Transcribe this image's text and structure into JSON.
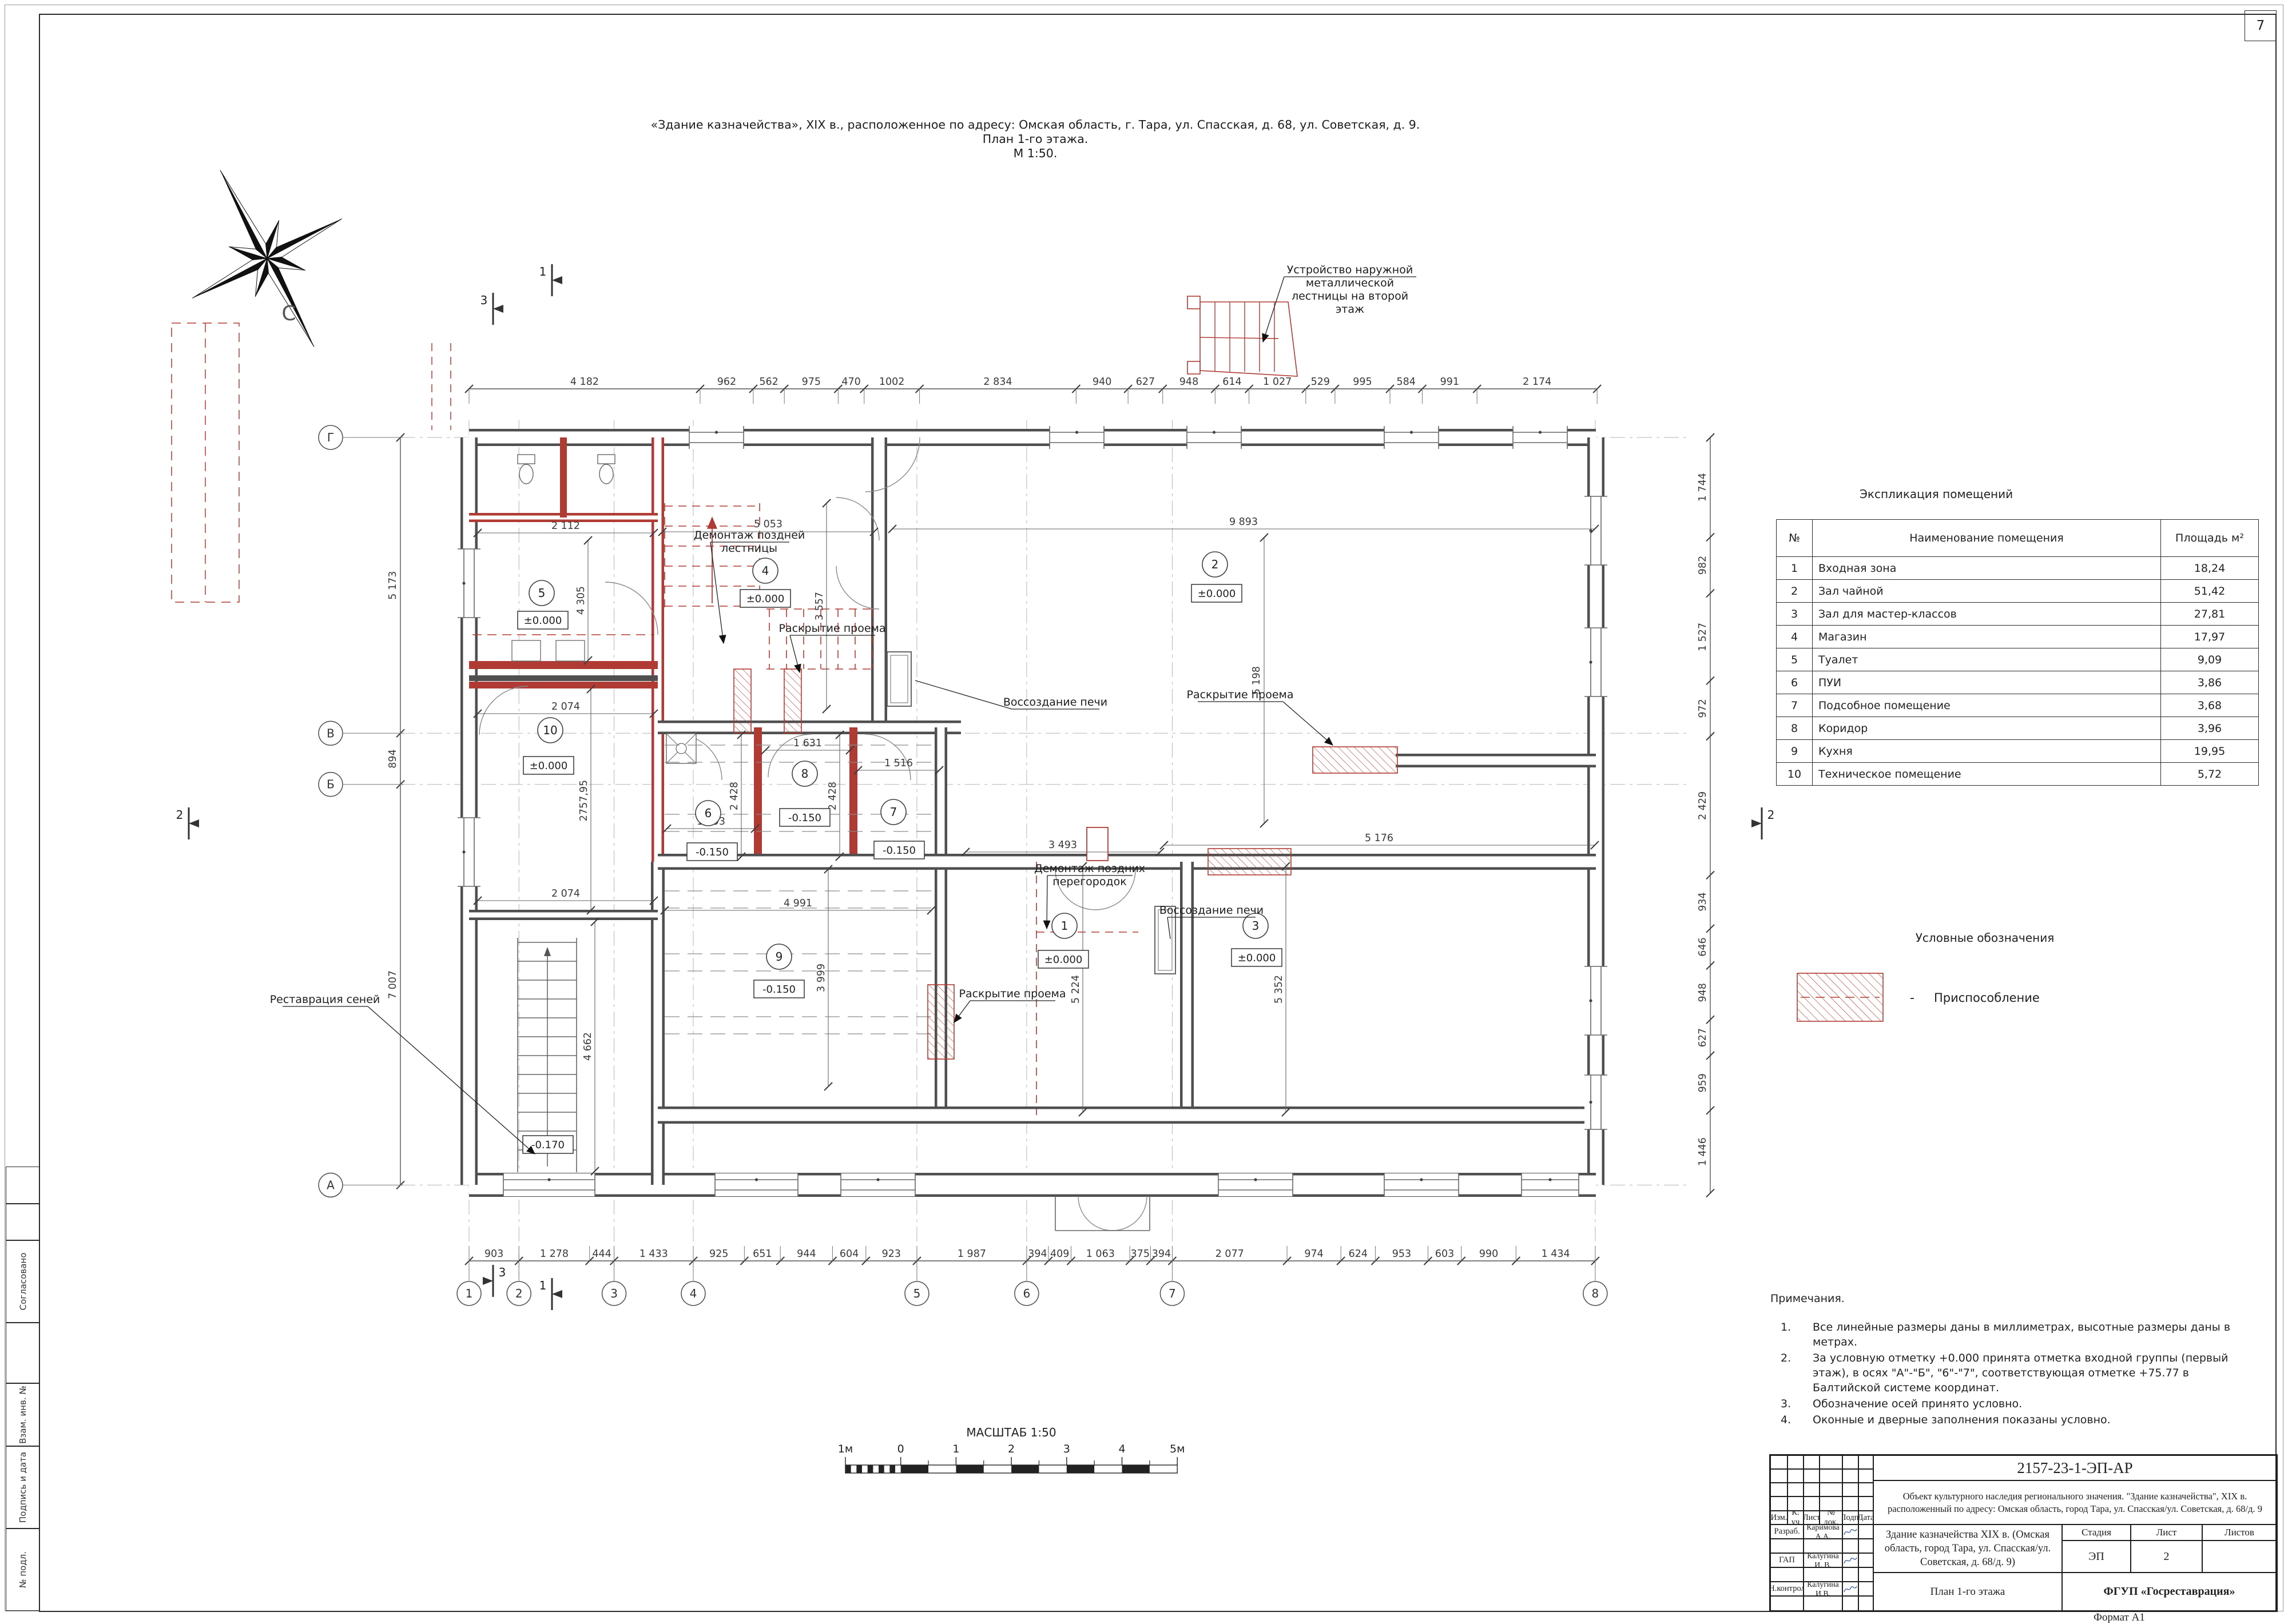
{
  "page": {
    "sheet_corner_number": "7",
    "format_label": "Формат А1"
  },
  "drawing_title": {
    "line1": "«Здание казначейства», XIX в., расположенное по адресу: Омская область, г. Тара, ул. Спасская, д. 68, ул. Советская, д. 9.",
    "line2": "План 1-го этажа.",
    "line3": "М 1:50."
  },
  "compass": {
    "north_label": "С"
  },
  "explication": {
    "title": "Экспликация помещений",
    "columns": [
      "№",
      "Наименование помещения",
      "Площадь м²"
    ],
    "rows": [
      {
        "num": "1",
        "name": "Входная зона",
        "area": "18,24"
      },
      {
        "num": "2",
        "name": "Зал чайной",
        "area": "51,42"
      },
      {
        "num": "3",
        "name": "Зал для мастер-классов",
        "area": "27,81"
      },
      {
        "num": "4",
        "name": "Магазин",
        "area": "17,97"
      },
      {
        "num": "5",
        "name": "Туалет",
        "area": "9,09"
      },
      {
        "num": "6",
        "name": "ПУИ",
        "area": "3,86"
      },
      {
        "num": "7",
        "name": "Подсобное помещение",
        "area": "3,68"
      },
      {
        "num": "8",
        "name": "Коридор",
        "area": "3,96"
      },
      {
        "num": "9",
        "name": "Кухня",
        "area": "19,95"
      },
      {
        "num": "10",
        "name": "Техническое помещение",
        "area": "5,72"
      }
    ]
  },
  "legend": {
    "title": "Условные обозначения",
    "dash": "-",
    "item_label": "Приспособление"
  },
  "notes": {
    "title": "Примечания.",
    "items": [
      {
        "num": "1.",
        "text": "Все линейные размеры даны в миллиметрах, высотные размеры даны в метрах."
      },
      {
        "num": "2.",
        "text": "За условную отметку +0.000 принята отметка входной группы (первый этаж), в осях \"А\"-\"Б\", \"6\"-\"7\", соответствующая отметке +75.77 в Балтийской системе координат."
      },
      {
        "num": "3.",
        "text": "Обозначение осей принято условно."
      },
      {
        "num": "4.",
        "text": "Оконные и дверные заполнения показаны условно."
      }
    ]
  },
  "scale_bar": {
    "title": "МАСШТАБ 1:50",
    "tick_labels": [
      "1м",
      "0",
      "1",
      "2",
      "3",
      "4",
      "5м"
    ]
  },
  "stamp": {
    "doc_number": "2157-23-1-ЭП-АР",
    "object_description": "Объект культурного наследия регионального значения. \"Здание казначейства\", XIX в. расположенный по адресу: Омская область, город Тара, ул. Спасская/ул. Советская, д. 68/д. 9",
    "project_title": "Здание казначейства XIX в. (Омская область, город Тара, ул. Спасская/ул. Советская, д. 68/д. 9)",
    "sheet_title": "План 1-го этажа",
    "organization": "ФГУП «Госреставрация»",
    "header_cols": [
      "Изм.",
      "К. уч",
      "Лист",
      "№ док.",
      "Подп.",
      "Дата"
    ],
    "roles": [
      {
        "role": "Разраб.",
        "name": "Каримова А.А."
      },
      {
        "role": "ГАП",
        "name": "Калугина И. В."
      },
      {
        "role": "Н.контрол",
        "name": "Калугина И.В."
      }
    ],
    "stage_label": "Стадия",
    "sheet_label": "Лист",
    "sheets_label": "Листов",
    "stage": "ЭП",
    "sheet": "2",
    "sheets": ""
  },
  "sidebar": {
    "labels": [
      "Согласовано",
      "Взам. инв. №",
      "Подпись и дата",
      "№ подл."
    ]
  },
  "plan": {
    "axes_bottom": [
      "1",
      "2",
      "3",
      "4",
      "5",
      "6",
      "7",
      "8"
    ],
    "axes_left": [
      "Г",
      "В",
      "Б",
      "А"
    ],
    "dims_top": [
      "4 182",
      "962",
      "562",
      "975",
      "470",
      "1002",
      "2 834",
      "940",
      "627",
      "948",
      "614",
      "1 027",
      "529",
      "995",
      "584",
      "991",
      "2 174"
    ],
    "dims_bottom": [
      "903",
      "1 278",
      "444",
      "1 433",
      "925",
      "651",
      "944",
      "604",
      "923",
      "1 987",
      "394",
      "409",
      "1 063",
      "375",
      "394",
      "2 077",
      "974",
      "624",
      "953",
      "603",
      "990",
      "1 434"
    ],
    "dims_left": [
      "5 173",
      "894",
      "7 007"
    ],
    "dims_right": [
      "1 744",
      "982",
      "1 527",
      "972",
      "2 429",
      "934",
      "646",
      "948",
      "627",
      "959",
      "1 446"
    ],
    "dims_inner": [
      "5 053",
      "3 557",
      "9 893",
      "5 198",
      "2 112",
      "4 305",
      "2 074",
      "2757,95",
      "1 631",
      "1 516",
      "2 428",
      "2 428",
      "1 593",
      "4 991",
      "3 999",
      "3 493",
      "5 224",
      "5 176",
      "5 352",
      "4 662",
      "2 074"
    ],
    "rooms": [
      {
        "num": "1",
        "elevation": "±0.000"
      },
      {
        "num": "2",
        "elevation": "±0.000"
      },
      {
        "num": "3",
        "elevation": "±0.000"
      },
      {
        "num": "4",
        "elevation": "±0.000"
      },
      {
        "num": "5",
        "elevation": "±0.000"
      },
      {
        "num": "6",
        "elevation": "-0.150"
      },
      {
        "num": "7",
        "elevation": "-0.150"
      },
      {
        "num": "8",
        "elevation": "-0.150"
      },
      {
        "num": "9",
        "elevation": "-0.150"
      },
      {
        "num": "10",
        "elevation": "±0.000"
      }
    ],
    "extra_elevations": [
      "-0.170"
    ],
    "annotations": [
      {
        "id": "external-stair",
        "lines": [
          "Устройство наружной",
          "металлической",
          "лестницы на второй",
          "этаж"
        ]
      },
      {
        "id": "demolish-stair",
        "lines": [
          "Демонтаж поздней",
          "лестницы"
        ]
      },
      {
        "id": "open-1",
        "lines": [
          "Раскрытие проема"
        ]
      },
      {
        "id": "stove-1",
        "lines": [
          "Воссоздание печи"
        ]
      },
      {
        "id": "open-2",
        "lines": [
          "Раскрытие проема"
        ]
      },
      {
        "id": "partitions",
        "lines": [
          "Демонтаж поздних",
          "перегородок"
        ]
      },
      {
        "id": "stove-2",
        "lines": [
          "Воссоздание печи"
        ]
      },
      {
        "id": "open-3",
        "lines": [
          "Раскрытие проема"
        ]
      },
      {
        "id": "seni",
        "lines": [
          "Реставрация сеней"
        ]
      }
    ],
    "section_markers": [
      "1",
      "2",
      "3"
    ],
    "colors": {
      "accent_red": "#b03a34",
      "wall_grey": "#4f4f4f",
      "thin_line": "#6f6f6f"
    }
  }
}
